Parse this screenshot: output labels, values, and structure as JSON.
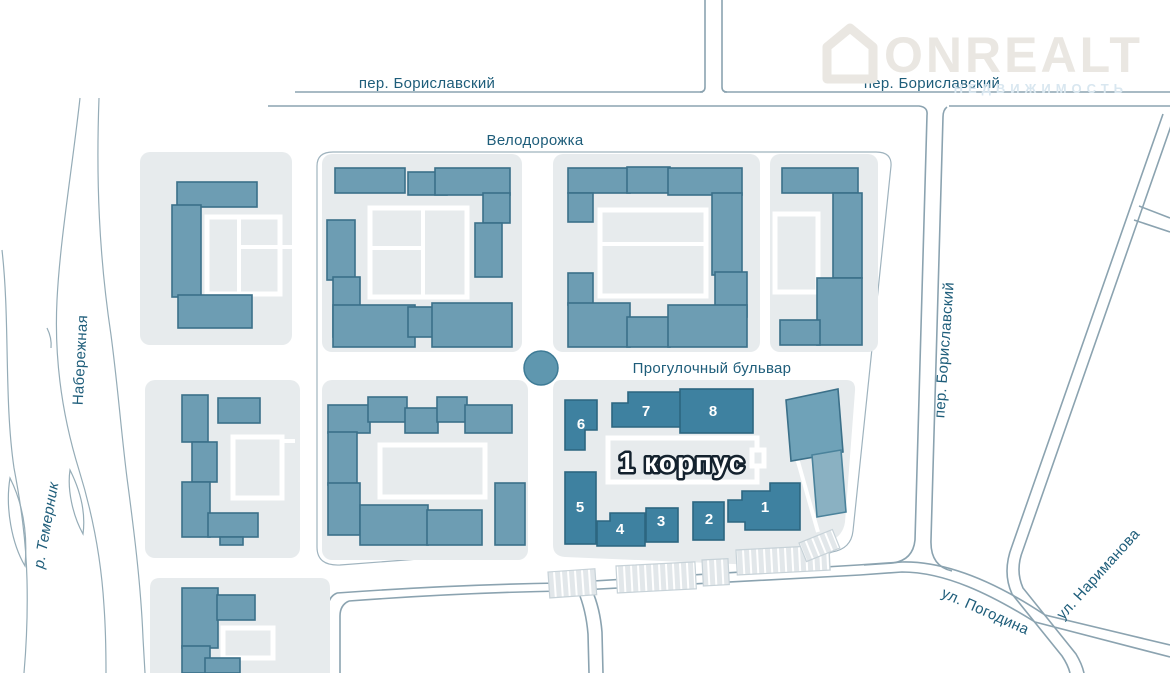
{
  "map": {
    "labels": {
      "pereulok_borislavsky_top_left": "пер. Бориславский",
      "pereulok_borislavsky_top_right": "пер. Бориславский",
      "pereulok_borislavsky_right": "пер. Бориславский",
      "velodorozhka": "Велодорожка",
      "progulochny_bulvar": "Прогулочный бульвар",
      "ulitsa_pogodina": "ул. Погодина",
      "ulitsa_narimanova": "ул. Нариманова",
      "naberezhnaya": "Набережная",
      "reka_temernik": "р. Темерник",
      "korpus_label": "1 корпус"
    },
    "buildings": {
      "b1": "1",
      "b2": "2",
      "b3": "3",
      "b4": "4",
      "b5": "5",
      "b6": "6",
      "b7": "7",
      "b8": "8"
    },
    "logo": {
      "title": "ONREALT",
      "subtitle": "НЕДВИЖИМОСТЬ",
      "icon": "house-icon"
    },
    "colors": {
      "street_label": "#1e5d7a",
      "building_fill": "#6d9db3",
      "building_stroke": "#3b7089",
      "building_dark_fill": "#3e81a0",
      "plot_fill": "#e7ebed",
      "road_line": "#8ba3b0",
      "korpus_text": "#ffffff",
      "korpus_outline": "#14222e",
      "logo_color": "#eae7e2"
    }
  }
}
